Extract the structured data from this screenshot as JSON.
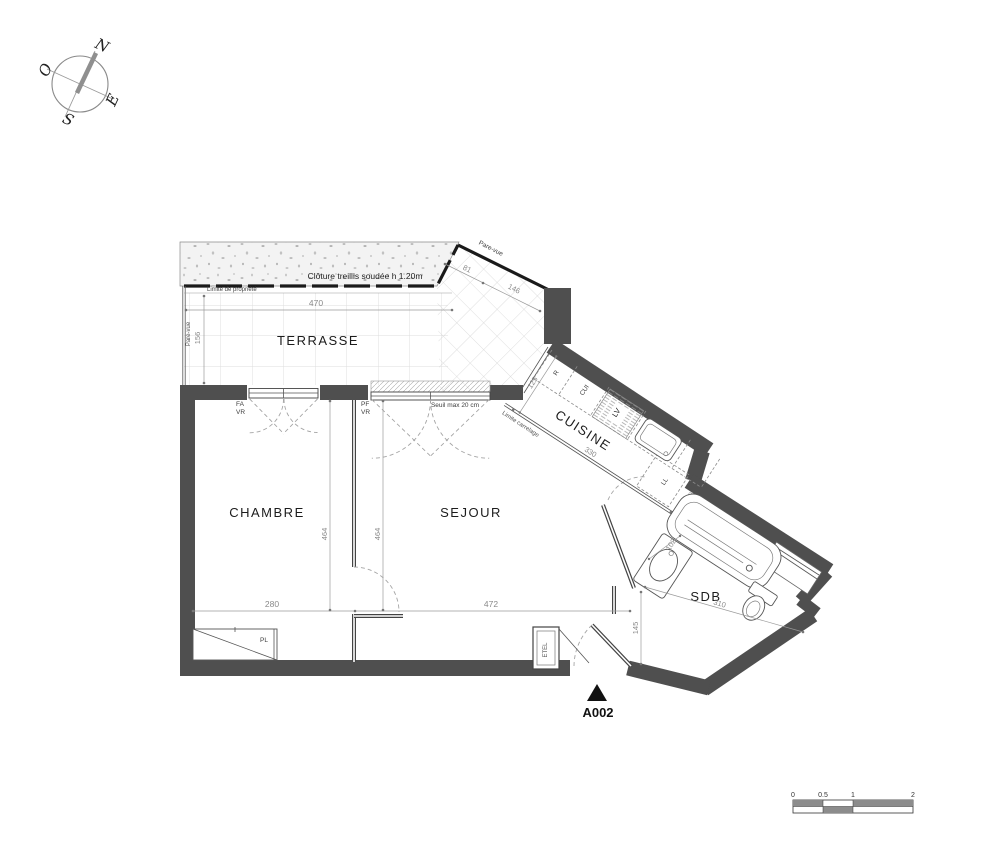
{
  "colors": {
    "wall": "#4f4f4f",
    "line": "#3c3c3c",
    "dim_text": "#8a8a8a",
    "grid": "#dcdcdc",
    "marker": "#111111"
  },
  "compass": {
    "north": "N",
    "west": "O",
    "east": "E",
    "south": "S"
  },
  "terrace": {
    "label": "TERRASSE",
    "fence": "Clôture treillis soudée h 1.20m",
    "property_limit": "Limite de propriété",
    "pare_vue_left": "Pare-vue",
    "pare_vue_diag": "Pare-vue",
    "dim_width": "470",
    "dim_depth": "156",
    "dim_diag_short": "81",
    "dim_diag_long": "146"
  },
  "rooms": {
    "chambre": {
      "label": "CHAMBRE",
      "dim_width": "280",
      "dim_height": "464"
    },
    "sejour": {
      "label": "SEJOUR",
      "dim_width": "472",
      "dim_height": "464"
    },
    "cuisine": {
      "label": "CUISINE",
      "dim_length": "330",
      "dim_depth": "125",
      "tile_limit": "Limite carrelage",
      "appliance_fridge": "R",
      "appliance_cooker": "CUI",
      "appliance_dishwasher": "LV",
      "appliance_washer": "LL"
    },
    "sdb": {
      "label": "SDB",
      "dim_length": "310",
      "dim_basin": "102"
    },
    "hall": {
      "dim_width": "145"
    }
  },
  "openings": {
    "window_chambre_type": "FA",
    "window_chambre_shutter": "VR",
    "window_sejour_type": "PF",
    "window_sejour_shutter": "VR",
    "sill_note": "Seuil max 20 cm"
  },
  "storage": {
    "closet": "PL",
    "utility": "ETEL"
  },
  "entrance": {
    "unit": "A002"
  },
  "scale_bar": {
    "t0": "0",
    "t1": "0.5",
    "t2": "1",
    "t3": "2"
  }
}
